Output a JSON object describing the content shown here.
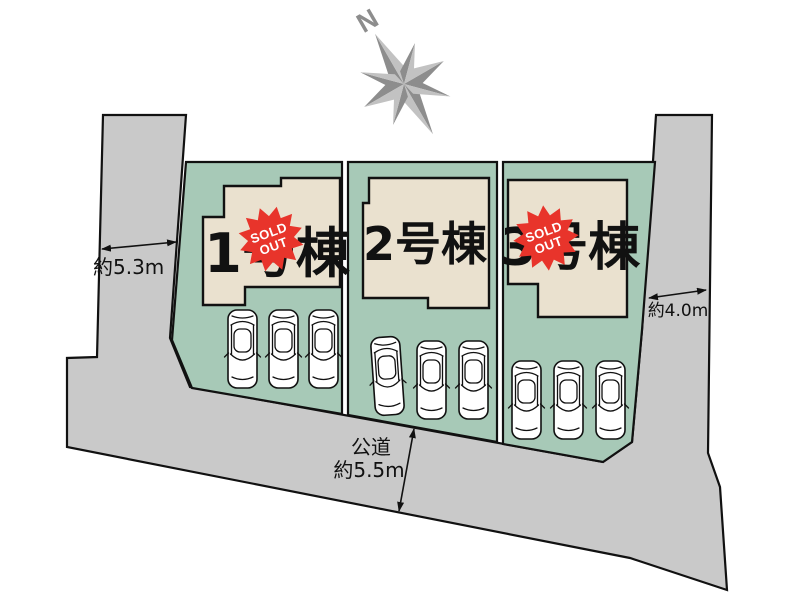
{
  "plan": {
    "compass": {
      "north_label": "N"
    },
    "buildings": [
      {
        "label": "1号棟",
        "sold_out": true
      },
      {
        "label": "2号棟",
        "sold_out": false
      },
      {
        "label": "3号棟",
        "sold_out": true
      }
    ],
    "sold_out_badge": {
      "line1": "SOLD",
      "line2": "OUT"
    },
    "dimensions": {
      "west_road": "約5.3m",
      "east_road": "約4.0m",
      "south_road_type": "公道",
      "south_road": "約5.5m"
    },
    "parking_cars_per_lot": 3,
    "colors": {
      "road": "#c9c9c9",
      "lot": "#a7c9b7",
      "building": "#eae1cf",
      "badge": "#e8342b",
      "compass": "#8d8d8d",
      "line": "#111111"
    }
  }
}
